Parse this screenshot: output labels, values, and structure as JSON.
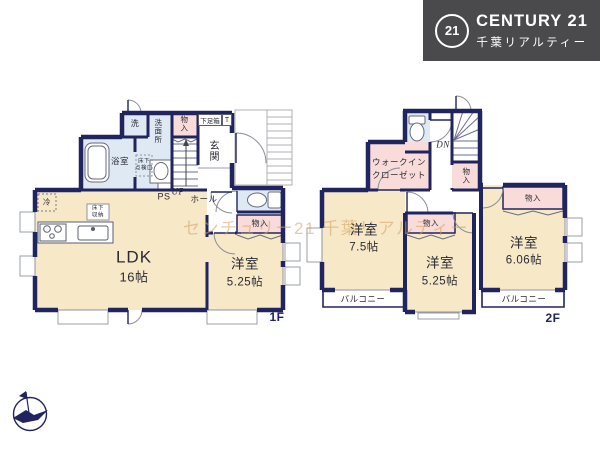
{
  "header": {
    "logo_badge": "21",
    "brand": "CENTURY 21",
    "company": "千葉リアルティー"
  },
  "watermark": {
    "text": "センチュリー21 千葉リアルティー"
  },
  "floor1": {
    "label": "1F",
    "ldk": {
      "name": "LDK",
      "size": "16帖"
    },
    "bedroom": {
      "name": "洋室",
      "size": "5.25帖"
    },
    "bath": "浴室",
    "wash": "洗",
    "washroom": "洗面所",
    "storage_upper": "物入",
    "shoe_box": "下足箱",
    "shoe_box_t": "T",
    "entrance": "玄関",
    "hall": "ホール",
    "stairs": "UP",
    "pipe_space": "PS",
    "storage_hall": "物入",
    "fridge": "冷",
    "underfloor_storage_line1": "床下",
    "underfloor_storage_line2": "収納",
    "inspection_line1": "床下",
    "inspection_line2": "点検口"
  },
  "floor2": {
    "label": "2F",
    "stairs": "DN",
    "wic_line1": "ウォークイン",
    "wic_line2": "クローゼット",
    "storage_stairs": "物入",
    "bedroom1": {
      "name": "洋室",
      "size": "7.5帖"
    },
    "bedroom2": {
      "name": "洋室",
      "size": "5.25帖"
    },
    "bedroom3": {
      "name": "洋室",
      "size": "6.06帖"
    },
    "storage2": "物入",
    "storage3": "物入",
    "balcony_left": "バルコニー",
    "balcony_right": "バルコニー"
  },
  "colors": {
    "wall": "#20255f",
    "room_cream": "#f7e8c8",
    "room_blue": "#dfe9f4",
    "room_pink": "#f9dcda",
    "header_bg": "#4a4a4c",
    "watermark": "rgba(214,158,94,0.55)"
  }
}
